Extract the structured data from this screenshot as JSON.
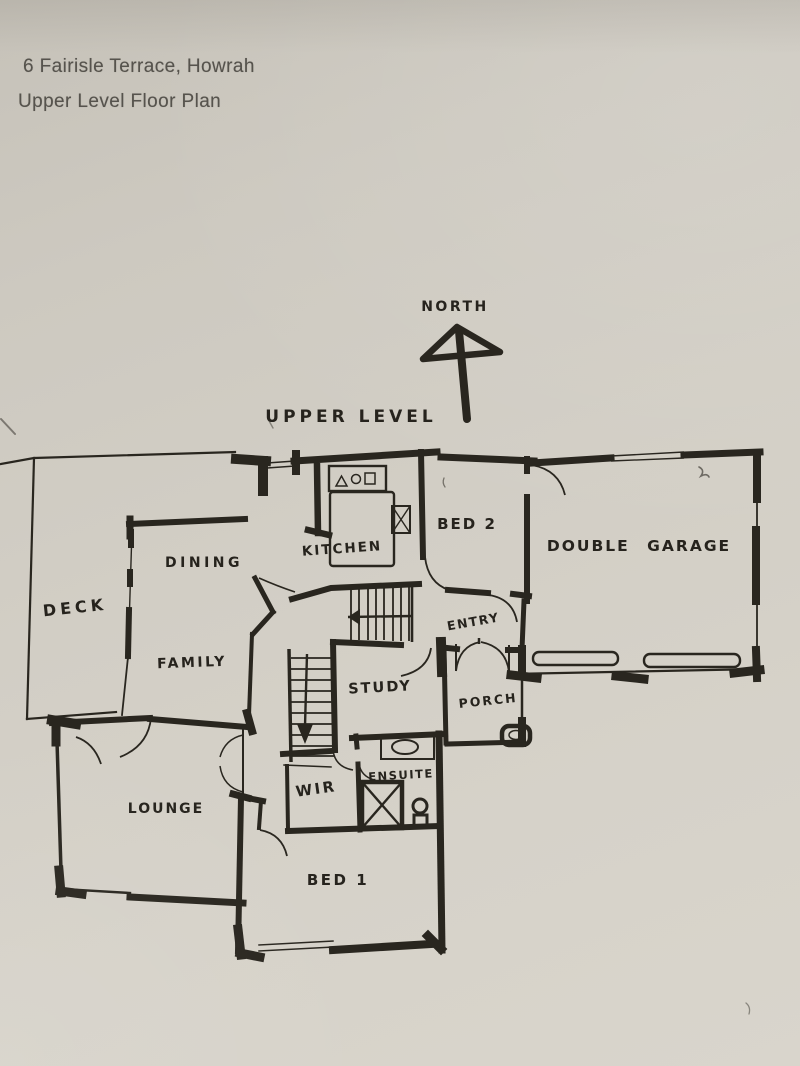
{
  "document": {
    "address_line": "6 Fairisle Terrace, Howrah",
    "title_line": "Upper Level Floor Plan"
  },
  "plan": {
    "level_label": "UPPER LEVEL",
    "compass_label": "NORTH",
    "rooms": {
      "deck": "DECK",
      "dining": "DINING",
      "family": "FAMILY",
      "kitchen": "KITCHEN",
      "bed2": "BED 2",
      "garage": "DOUBLE GARAGE",
      "entry": "ENTRY",
      "study": "STUDY",
      "porch": "PORCH",
      "lounge": "LOUNGE",
      "wir": "WIR",
      "ensuite": "ENSUITE",
      "bed1": "BED 1"
    },
    "colors": {
      "paper": "#d2cec5",
      "ink": "#29261f",
      "typed_text": "#56534d"
    }
  }
}
